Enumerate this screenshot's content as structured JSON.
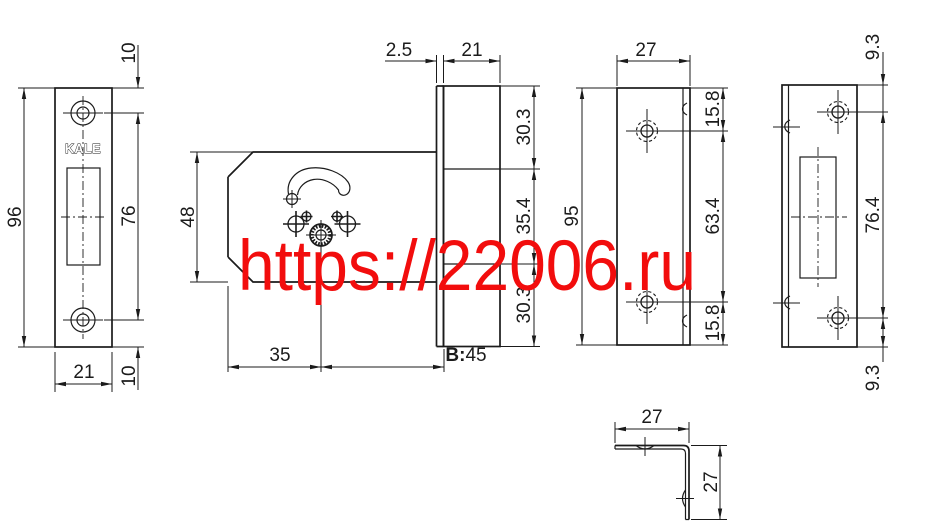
{
  "watermark": {
    "text": "https://22006.ru",
    "color": "#f20d0d"
  },
  "brand": "KALE",
  "views": {
    "faceplate_front": {
      "height": "96",
      "hole_top_offset": "10",
      "hole_spacing": "76",
      "hole_bottom_offset": "10",
      "width": "21"
    },
    "lock_case": {
      "case_height": "48",
      "faceplate_thickness": "2.5",
      "faceplate_width": "21",
      "upper_section": "30.3",
      "middle_section": "35.4",
      "lower_section": "30.3",
      "hub_offset": "35",
      "backset_prefix": "B:",
      "backset_value": "45"
    },
    "cover_plate": {
      "width": "27",
      "height": "95",
      "hole_top_offset": "15.8",
      "hole_spacing": "63.4",
      "hole_bottom_offset": "15.8"
    },
    "strike_plate": {
      "hole_top_offset": "9.3",
      "hole_spacing": "76.4",
      "hole_bottom_offset": "9.3"
    },
    "angle_bracket": {
      "width": "27",
      "height": "27"
    }
  }
}
